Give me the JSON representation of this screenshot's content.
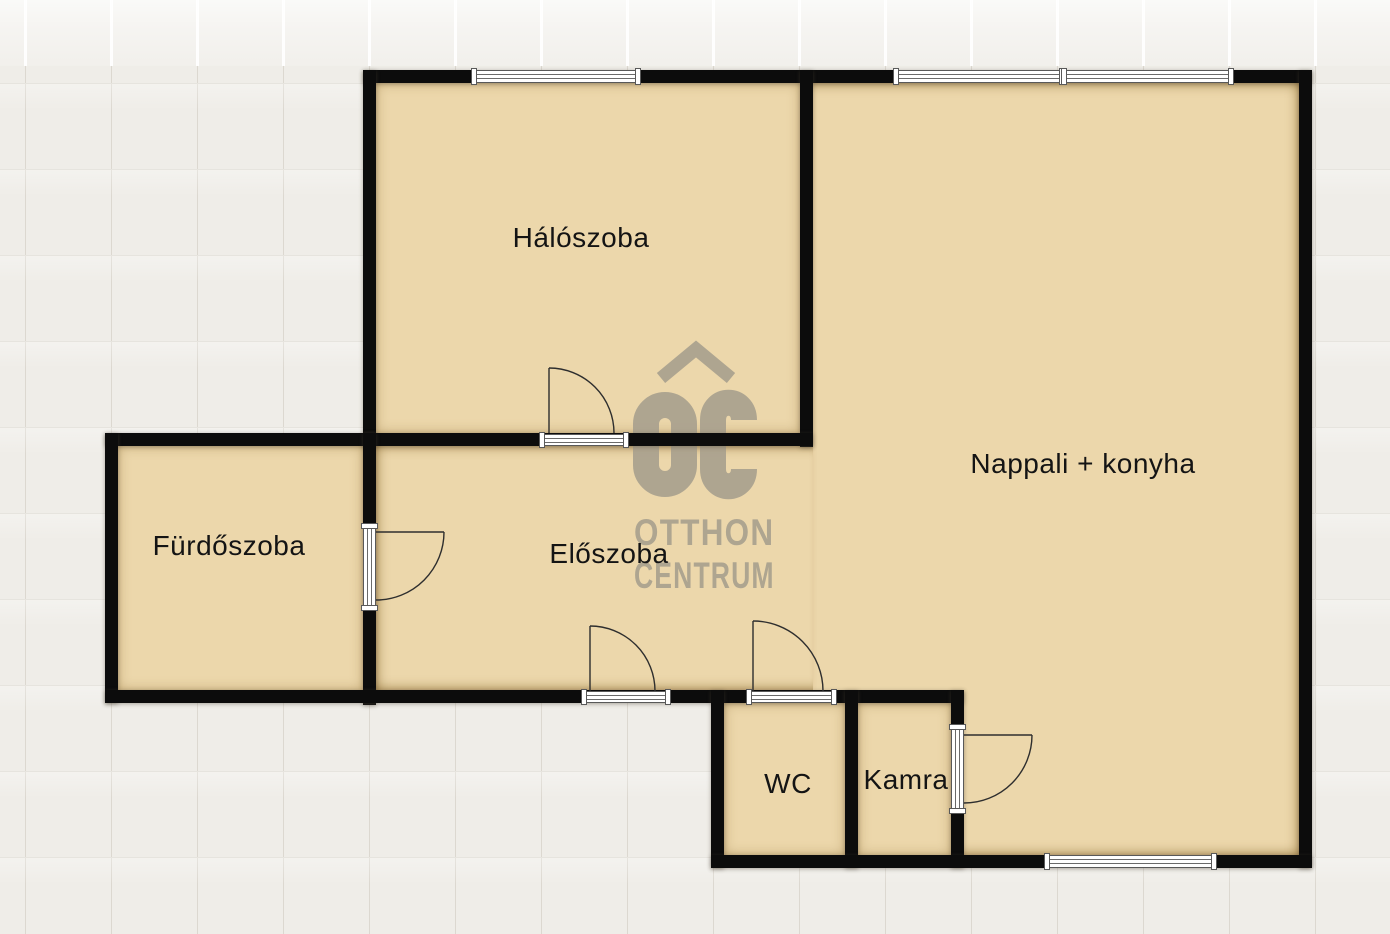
{
  "plan": {
    "rooms": [
      {
        "label": "Hálószoba"
      },
      {
        "label": "Nappali + konyha"
      },
      {
        "label": "Fürdőszoba"
      },
      {
        "label": "Előszoba"
      },
      {
        "label": "WC"
      },
      {
        "label": "Kamra"
      }
    ],
    "watermark": {
      "line1": "OTTHON",
      "line2": "CENTRUM"
    },
    "colors": {
      "background": "#efede8",
      "grid_line": "#dcd8d0",
      "floor": "#ecd7ab",
      "wall": "#0c0c0c",
      "door_line": "#2e2e2e",
      "opening_frame": "#595959",
      "watermark": "#a8a08e",
      "label_text": "#141414"
    }
  }
}
